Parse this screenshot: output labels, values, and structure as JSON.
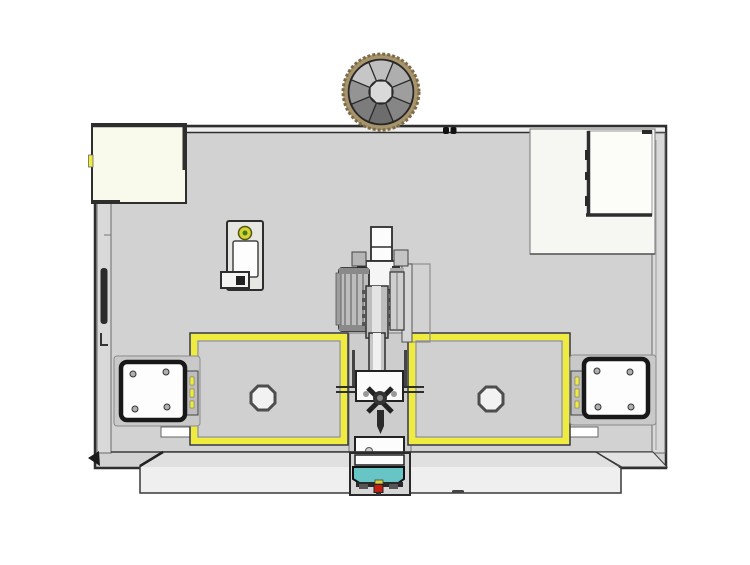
{
  "scene": {
    "description_visible_text": "",
    "background": "#ffffff"
  },
  "colors": {
    "page_bg": "#ffffff",
    "outline": "#2e2e2e",
    "body": "#d2d2d2",
    "wall": "#d9d9d9",
    "edge_light": "#eeeeee",
    "cream_panel": "#fafaec",
    "white_panel": "#f6f6f3",
    "inner_panel": "#fcfcf9",
    "window_fill": "#d0d0d0",
    "safety_yellow": "#f0ec3e",
    "knurl_tan": "#a8946c",
    "disc_rim": "#7c6c48",
    "hub": "#d9d9d9",
    "teal": "#68c5c6",
    "alarm_red": "#c41f12",
    "indicator_yellow": "#d6d332",
    "indicator_green": "#3f7d20",
    "motor_border": "#181818",
    "bolt": "#b0b0b0",
    "base": "#efefef",
    "base_top": "#e0e0e0",
    "mech_light": "#ececec",
    "mech_mid": "#bdbdbd",
    "mech_dark": "#4a4a4a",
    "white": "#ffffff",
    "disc_wedges": [
      "#bfbfbf",
      "#aeaeae",
      "#9e9e9e",
      "#868686",
      "#6d6d6d",
      "#7c7c7c",
      "#949494",
      "#c6c6c6"
    ]
  }
}
